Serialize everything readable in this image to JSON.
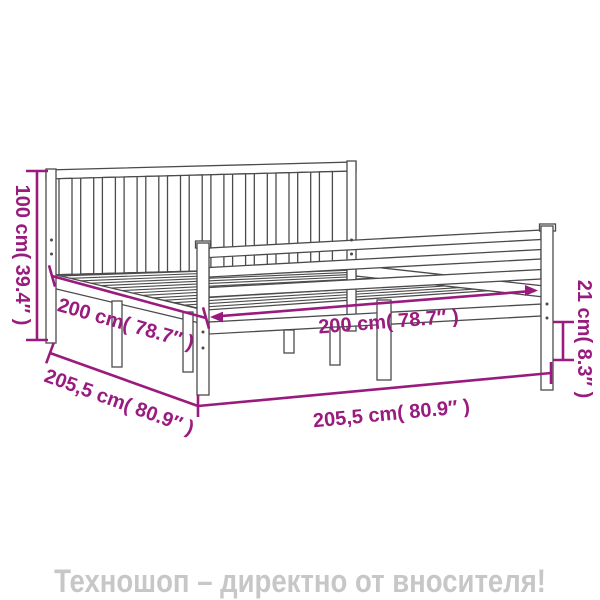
{
  "diagram": {
    "type": "bed-frame-with-headboard-dimension-drawing",
    "labels": {
      "headboard_height": "100 cm( 39.4″ )",
      "length_inner": "200 cm( 78.7″ )",
      "width_inner": "200 cm( 78.7″ )",
      "length_outer": "205,5 cm( 80.9″ )",
      "width_outer": "205,5 cm( 80.9″ )",
      "rail_height": "21 cm( 8.3″ )"
    },
    "measurements": [
      {
        "id": "headboard_height",
        "cm": 100,
        "inches": 39.4
      },
      {
        "id": "length_inner",
        "cm": 200,
        "inches": 78.7
      },
      {
        "id": "width_inner",
        "cm": 200,
        "inches": 78.7
      },
      {
        "id": "length_outer",
        "cm": 205.5,
        "inches": 80.9
      },
      {
        "id": "width_outer",
        "cm": 205.5,
        "inches": 80.9
      },
      {
        "id": "rail_height",
        "cm": 21,
        "inches": 8.3
      }
    ],
    "colors": {
      "dimension_accent": "#9a1b7e",
      "line_art": "#4b4b4b",
      "watermark": "#c7c7c7",
      "background": "#ffffff"
    }
  },
  "footer": {
    "watermark": "Техношоп – директно от вносителя!"
  }
}
